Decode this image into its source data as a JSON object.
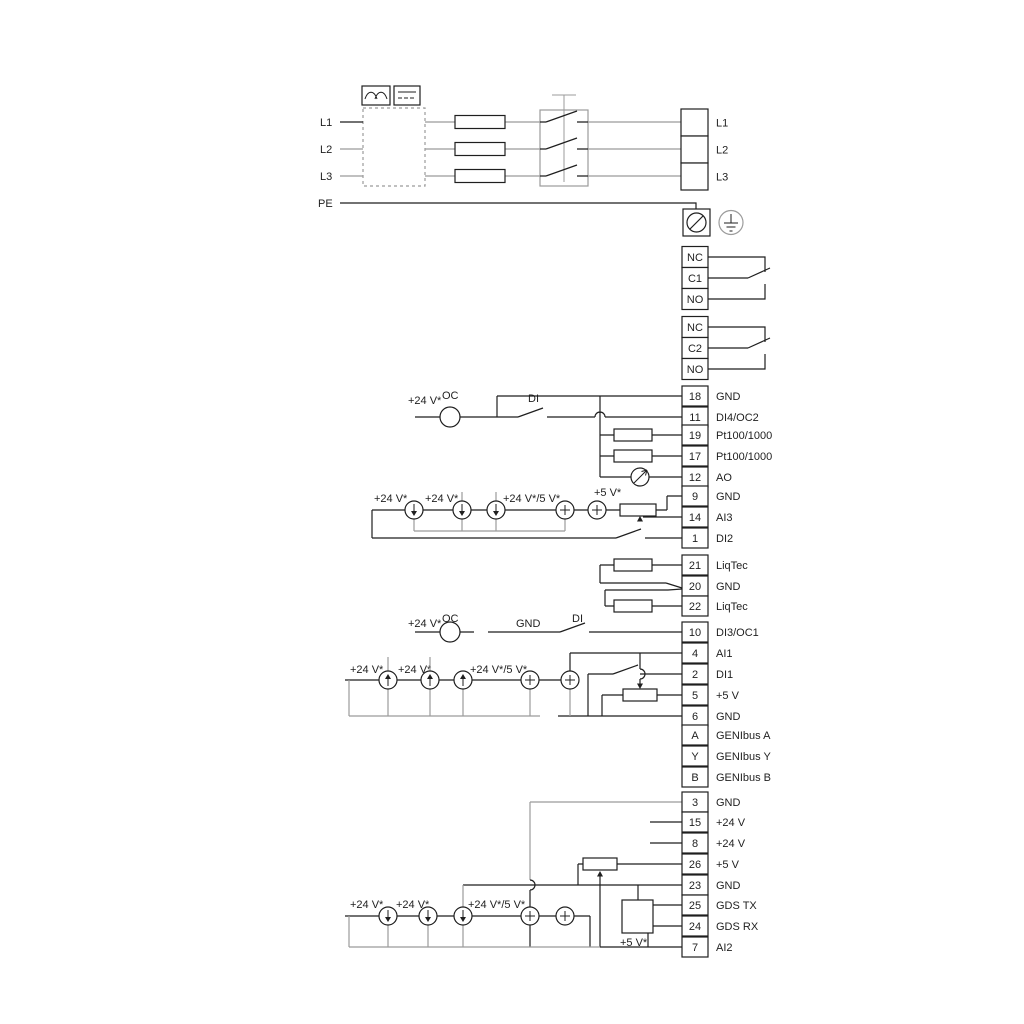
{
  "colors": {
    "wire_black": "#1f1f1f",
    "wire_gray": "#9b9b9b",
    "background": "#ffffff"
  },
  "power": {
    "input_labels": [
      "L1",
      "L2",
      "L3",
      "PE"
    ],
    "output_labels": [
      "L1",
      "L2",
      "L3"
    ]
  },
  "relays": [
    {
      "cells": [
        "NC",
        "C1",
        "NO"
      ]
    },
    {
      "cells": [
        "NC",
        "C2",
        "NO"
      ]
    }
  ],
  "terminals": [
    {
      "num": "18",
      "label": "GND"
    },
    {
      "num": "11",
      "label": "DI4/OC2"
    },
    {
      "num": "19",
      "label": "Pt100/1000"
    },
    {
      "num": "17",
      "label": "Pt100/1000"
    },
    {
      "num": "12",
      "label": "AO"
    },
    {
      "num": "9",
      "label": "GND"
    },
    {
      "num": "14",
      "label": "AI3"
    },
    {
      "num": "1",
      "label": "DI2"
    },
    {
      "num": "21",
      "label": "LiqTec"
    },
    {
      "num": "20",
      "label": "GND"
    },
    {
      "num": "22",
      "label": "LiqTec"
    },
    {
      "num": "10",
      "label": "DI3/OC1"
    },
    {
      "num": "4",
      "label": "AI1"
    },
    {
      "num": "2",
      "label": "DI1"
    },
    {
      "num": "5",
      "label": "+5 V"
    },
    {
      "num": "6",
      "label": "GND"
    },
    {
      "num": "A",
      "label": "GENIbus A"
    },
    {
      "num": "Y",
      "label": "GENIbus Y"
    },
    {
      "num": "B",
      "label": "GENIbus B"
    },
    {
      "num": "3",
      "label": "GND"
    },
    {
      "num": "15",
      "label": "+24 V"
    },
    {
      "num": "8",
      "label": "+24 V"
    },
    {
      "num": "26",
      "label": "+5 V"
    },
    {
      "num": "23",
      "label": "GND"
    },
    {
      "num": "25",
      "label": "GDS TX"
    },
    {
      "num": "24",
      "label": "GDS RX"
    },
    {
      "num": "7",
      "label": "AI2"
    }
  ],
  "annotations": {
    "di4_supply": "+24 V*",
    "di4_oc": "OC",
    "di4_di": "DI",
    "ai3_supply_a": "+24 V*",
    "ai3_supply_b": "+24 V*",
    "ai3_supply_c": "+24 V*/5 V*",
    "ai3_supply_d": "+5 V*",
    "di3_supply": "+24 V*",
    "di3_oc": "OC",
    "di3_gnd": "GND",
    "di3_di": "DI",
    "ai1_supply_a": "+24 V*",
    "ai1_supply_b": "+24 V*",
    "ai1_supply_c": "+24 V*/5 V*",
    "ai2_supply_a": "+24 V*",
    "ai2_supply_b": "+24 V*",
    "ai2_supply_c": "+24 V*/5 V*",
    "ai2_supply_d": "+5 V*"
  }
}
